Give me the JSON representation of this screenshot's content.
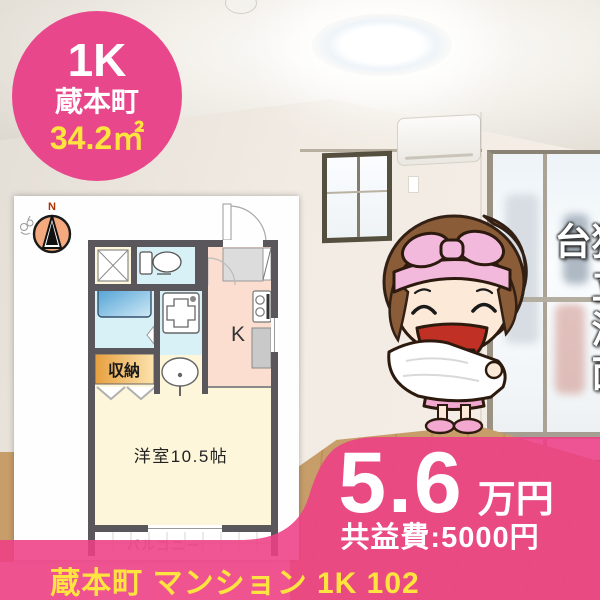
{
  "badge": {
    "layout_type": "1K",
    "location": "蔵本町",
    "floor_area": "34.2㎡"
  },
  "floor_plan": {
    "compass_label": "N",
    "kitchen_label": "K",
    "storage_label": "収納",
    "room_label": "洋室10.5帖",
    "balcony_label": "バルコニー"
  },
  "feature_ribbon": {
    "text": "独立洗面台"
  },
  "price_panel": {
    "rent": "5.6",
    "rent_unit": "万円",
    "common_fee": "共益費:5000円"
  },
  "caption": {
    "text": "蔵本町 マンション 1K 102"
  },
  "colors": {
    "accent_pink": "#e8488b",
    "overlay_pink": "#ee3f85",
    "highlight_yellow": "#ffe33f"
  }
}
